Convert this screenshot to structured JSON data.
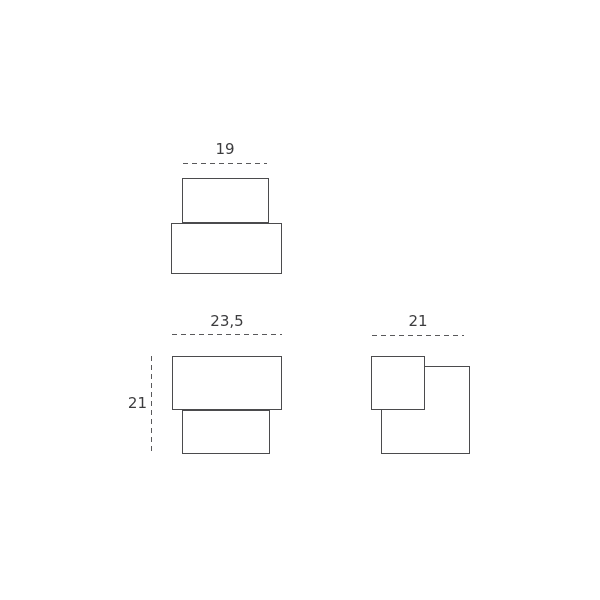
{
  "diagram": {
    "colors": {
      "background": "#ffffff",
      "line": "#4b4b4d",
      "dash": "#59595b",
      "text": "#3c3c3e"
    },
    "figures": {
      "top_view": {
        "width_label": "19"
      },
      "front_view": {
        "width_label": "23,5",
        "height_label": "21"
      },
      "side_view": {
        "width_label": "21"
      }
    }
  }
}
